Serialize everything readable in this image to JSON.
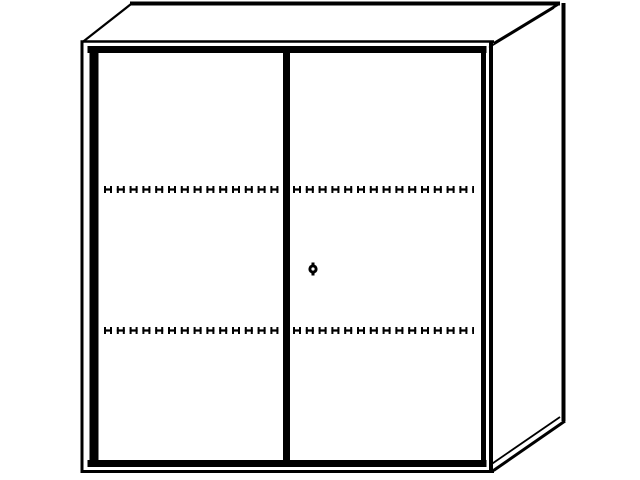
{
  "meta": {
    "description": "Black-and-white technical line drawing of a two-door cabinet (sideboard) shown in three-quarter perspective, with thick door outlines, a center divider, a round lock keyhole on the right door, and two horizontal dashed lines marking interior shelf positions",
    "object": "two-door cabinet"
  },
  "colors": {
    "line": "#000000",
    "background": "#ffffff"
  },
  "drawing": {
    "doors": 2,
    "shelf_lines": 2,
    "lock": "round keyhole on right door near center divider",
    "features": [
      "top panel in perspective",
      "right side panel in perspective",
      "left door",
      "right door",
      "center divider",
      "lock keyhole",
      "dashed shelf position lines",
      "base edge"
    ]
  }
}
